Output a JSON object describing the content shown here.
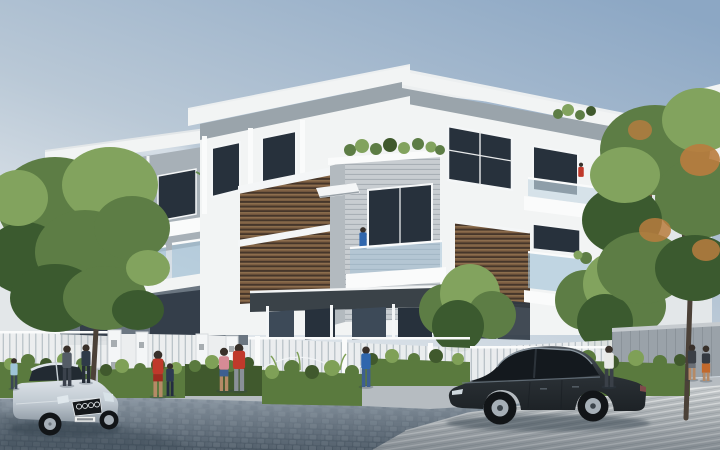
{
  "meta": {
    "type": "architectural-render",
    "subject": "modern three-story townhouse / villa complex street view, daytime",
    "width_px": 720,
    "height_px": 450,
    "visible_text": "none (license plate characters illegible)"
  },
  "palette": {
    "sky_top": "#8ca7c4",
    "sky_mid": "#b9c8d6",
    "sky_horizon": "#edf0f2",
    "cloud": "#ffffff",
    "wall_white": "#f2f4f4",
    "wall_bright": "#fafbfb",
    "wall_shade": "#e3e7e9",
    "band_gray": "#9aa4ab",
    "wall_gray": "#8e979f",
    "wall_gray_dark": "#6e7983",
    "siding_light": "#c8cdd1",
    "siding_line": "#a5acb2",
    "siding_side": "#b3babf",
    "window_dark": "#27313c",
    "window_mid": "#3d4a58",
    "frame_white": "#f4f6f7",
    "glass_blue": "#9fc0d6",
    "glass_light": "#c6d9e4",
    "louver_brown": "#7c5e42",
    "louver_light": "#9a7a55",
    "louver_dark": "#46362a",
    "fence_white": "#eceeef",
    "fence_gap": "#8a98a2",
    "fence_gray_wall": "#9aa2a9",
    "hedge_green": "#5a7a3e",
    "hedge_dark": "#40592d",
    "grass_light": "#7fa057",
    "tree_green": "#5d7d45",
    "tree_light": "#82a35e",
    "tree_dark": "#3b5a2f",
    "tree_orange": "#b97c3e",
    "trunk_brown": "#4b4138",
    "road_light": "#a3aeb9",
    "road_dark": "#5d6b78",
    "pave_light": "#c5c9cb",
    "pave_line": "#e9ebeb",
    "sidewalk": "#b6bcc1",
    "car_silver_hi": "#dde3e8",
    "car_silver": "#c2cbd3",
    "car_silver_lo": "#8e99a3",
    "car_dark_hi": "#4e565e",
    "car_dark": "#2b3136",
    "car_dark_lo": "#1d2226",
    "wheel_dark": "#121518",
    "rim_silver": "#a6afb7",
    "skin": "#b58a66",
    "hair_dark": "#38302a",
    "cloth_red": "#c0392b",
    "cloth_red_dark": "#9e2b20",
    "cloth_pink": "#d68b95",
    "cloth_blue": "#2f66ad",
    "cloth_navy": "#2d3a52",
    "cloth_white": "#e9eae8",
    "cloth_orange": "#c2692c",
    "cloth_gray": "#59626c",
    "denim": "#3e5f90",
    "shadow": "#33404c"
  },
  "scene": {
    "buildings": {
      "style": "modern flat-roof villas with wide white roof overhangs, gray recessed bands, brown wood louver screens, glass-railing balconies, horizontal siding accent boxes",
      "row": [
        "left villa partly behind tree",
        "middle villa with double louver panels",
        "main right villa with corner balcony",
        "background building far right",
        "background sliver far left"
      ]
    },
    "vehicles": [
      {
        "name": "silver-sedan",
        "view": "three-quarter front, facing viewer-right",
        "brand_mark": "four-ring grille logo",
        "license_plate": "white, characters illegible",
        "position": "bottom-left"
      },
      {
        "name": "dark-gray-sedan",
        "view": "side profile facing left",
        "position": "center-right on pavement"
      }
    ],
    "people": [
      {
        "name": "child-lightblue",
        "where": "far left at fence"
      },
      {
        "name": "pedestrian-gray",
        "where": "left fence"
      },
      {
        "name": "pedestrian-darknavy",
        "where": "left fence"
      },
      {
        "name": "woman-red-shorts",
        "where": "at gate"
      },
      {
        "name": "child-navy",
        "where": "at gate"
      },
      {
        "name": "woman-pink-top",
        "where": "right of gate"
      },
      {
        "name": "man-red-shirt",
        "where": "right of gate"
      },
      {
        "name": "woman-blue-jeans",
        "where": "at center fence"
      },
      {
        "name": "walker-white-shirt",
        "where": "right pavement"
      },
      {
        "name": "pedestrian-dark-top",
        "where": "far right"
      },
      {
        "name": "pedestrian-orange-skirt",
        "where": "far right"
      },
      {
        "name": "balcony-person-blue-middle-villa",
        "where": "small balcony, middle villa"
      },
      {
        "name": "balcony-person-blue-left-villa",
        "where": "glass balcony, left villa"
      },
      {
        "name": "balcony-person-red-main-villa",
        "where": "upper balcony, main villa"
      }
    ],
    "vegetation": [
      "large green tree left",
      "large green-orange tree right",
      "two round shrubs in yard",
      "hedge strips along fence",
      "planter row on accent box",
      "small palm fronds"
    ],
    "street": [
      "blue-gray cobblestone road bottom-left",
      "light striped concrete pavement bottom-right",
      "white picket fence with gate piers",
      "gray panel wall far right",
      "narrow sidewalk strip"
    ]
  }
}
